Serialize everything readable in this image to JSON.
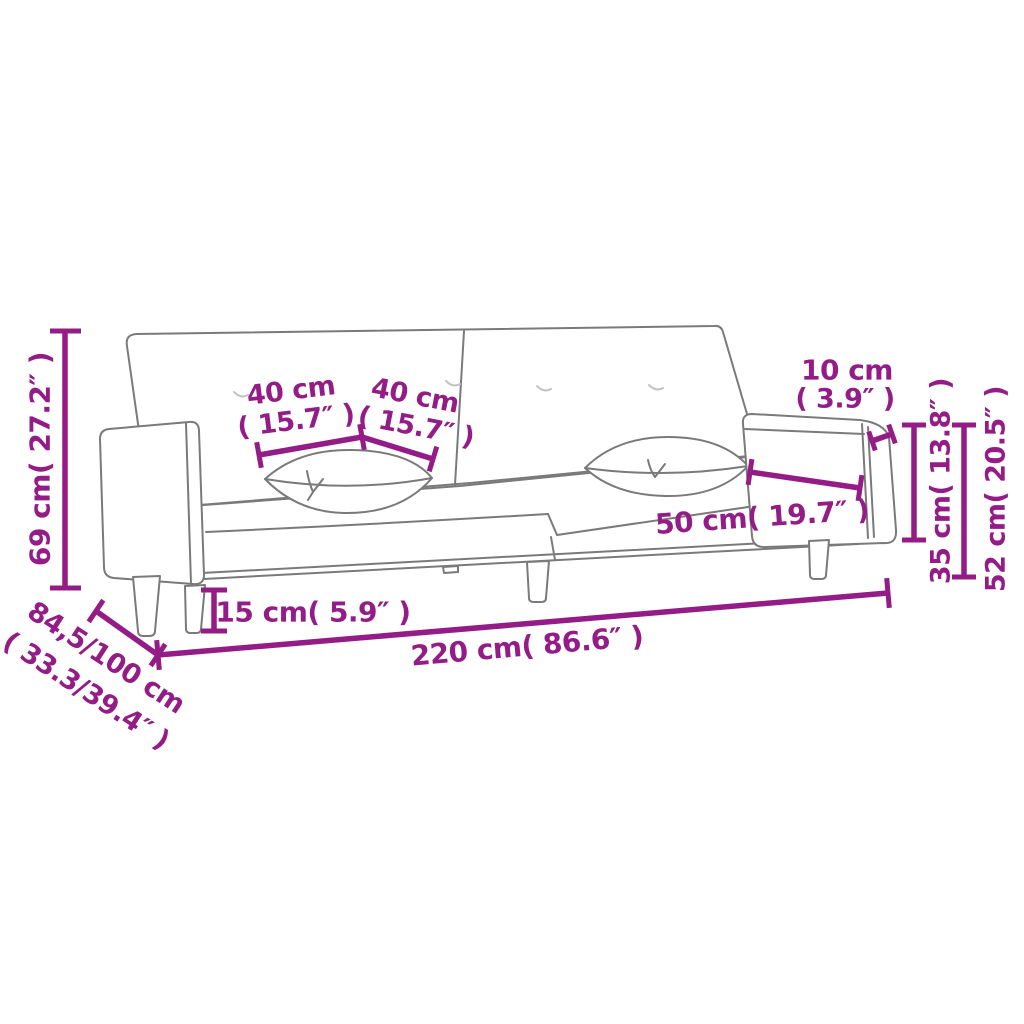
{
  "diagram": {
    "kind": "product-dimension-diagram",
    "product": "2-seater sofa bed with two pillows",
    "colors": {
      "dimension_accent": "#941C86",
      "sofa_outline": "#7a7a7a",
      "background": "#ffffff"
    },
    "dims": {
      "total_width": {
        "text": "220 cm( 86.6″ )"
      },
      "total_height": {
        "text": "69 cm( 27.2″ )"
      },
      "depth": {
        "line1": "84,5/100 cm",
        "line2": "( 33.3/39.4″ )"
      },
      "pillow_left": {
        "line1": "40 cm",
        "line2": "( 15.7″ )"
      },
      "pillow_right": {
        "line1": "40 cm",
        "line2": "( 15.7″ )"
      },
      "armrest_width": {
        "line1": "10 cm",
        "line2": "( 3.9″ )"
      },
      "armrest_to_seat": {
        "text": "35 cm( 13.8″ )"
      },
      "armrest_height": {
        "text": "52 cm( 20.5″ )"
      },
      "seat_depth": {
        "text": "50 cm( 19.7″ )"
      },
      "leg_height": {
        "text": "15 cm( 5.9″ )"
      }
    }
  }
}
